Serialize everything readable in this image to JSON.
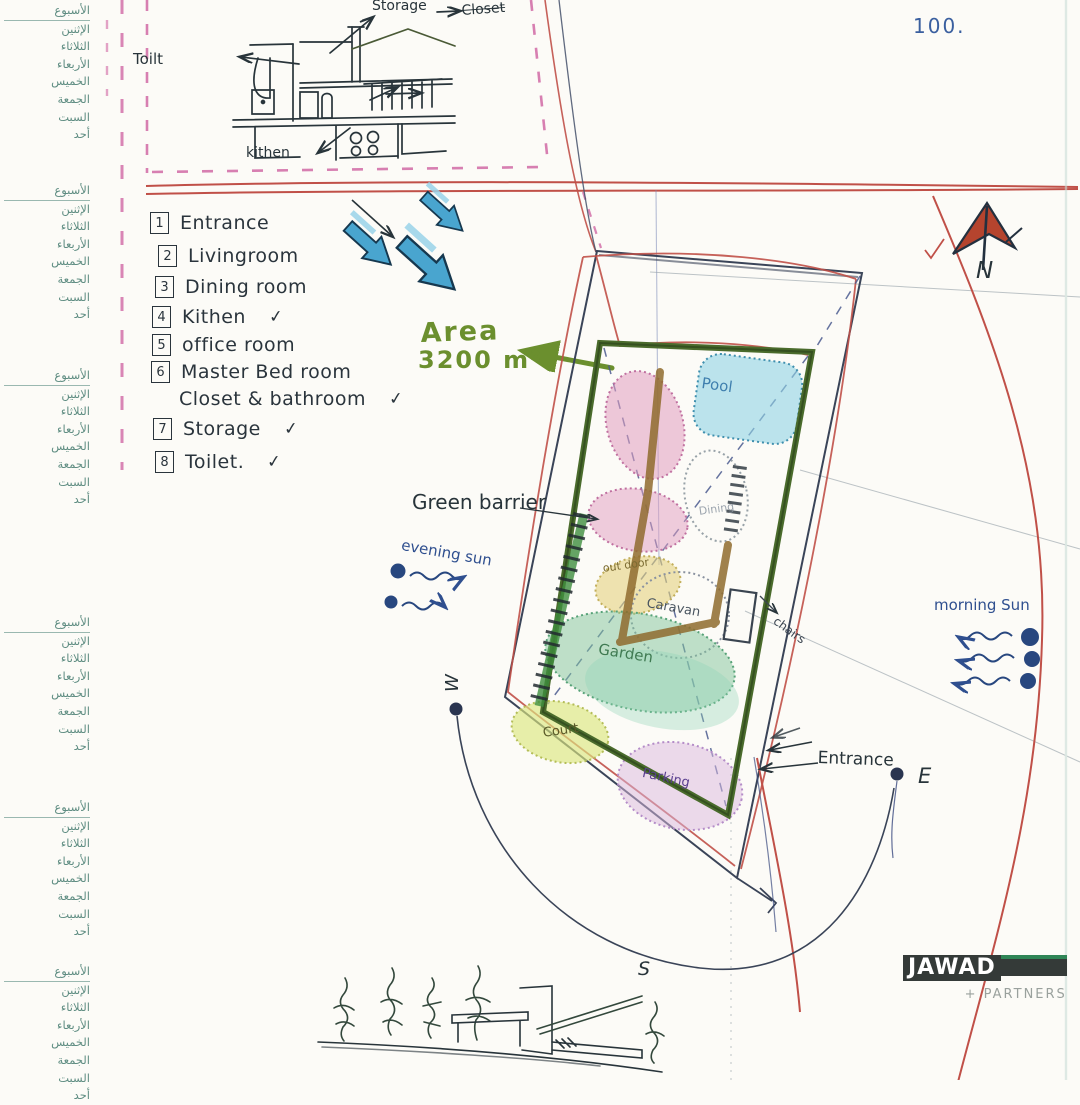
{
  "page": {
    "sheet_number": "100."
  },
  "palette": {
    "paper": "#fcfbf7",
    "ink": "#28343a",
    "red_pen": "#c05048",
    "pink_dash": "#d068a4",
    "cyan_arrow": "#49a5cf",
    "olive_marker": "#6b8f2e",
    "margin_teal": "#5f8d82",
    "blue_pen": "#2f4f8f",
    "green_wall": "#4a6b2c",
    "brown_path": "#8f6b2e",
    "logo_bar": "#343a38",
    "logo_green": "#2f8556"
  },
  "margin_calendar": {
    "week_label": "الأسبوع",
    "days": [
      "الإثنين",
      "الثلاثاء",
      "الأربعاء",
      "الخميس",
      "الجمعة",
      "السبت",
      "أحد"
    ]
  },
  "top_sketch": {
    "storage": "Storage",
    "closet": "Closet",
    "toilet": "Toilt",
    "kitchen": "kithen"
  },
  "legend": {
    "check_glyph": "✓",
    "items": [
      {
        "num": "1",
        "label": "Entrance"
      },
      {
        "num": "2",
        "label": "Livingroom"
      },
      {
        "num": "3",
        "label": "Dining room"
      },
      {
        "num": "4",
        "label": "Kithen",
        "checked": true
      },
      {
        "num": "5",
        "label": "office room"
      },
      {
        "num": "6",
        "label": "Master Bed room",
        "line2": "Closet & bathroom",
        "line2_checked": true
      },
      {
        "num": "7",
        "label": "Storage",
        "checked": true
      },
      {
        "num": "8",
        "label": "Toilet.",
        "checked": true
      }
    ]
  },
  "area_note": {
    "title": "Area",
    "value": "3200 m²"
  },
  "plan": {
    "green_barrier": "Green barrier",
    "side_note": "chairs",
    "zones": {
      "pool": "Pool",
      "dining": "Dining",
      "outdoor": "out door",
      "caravan": "Caravan",
      "garden": "Garden",
      "court": "Court",
      "parking": "Parking"
    }
  },
  "sun": {
    "evening": "evening sun",
    "morning": "morning Sun"
  },
  "compass": {
    "n": "N",
    "e": "E",
    "s": "S",
    "w": "W"
  },
  "entrance_label": "Entrance",
  "logo": {
    "brand": "JAWAD",
    "sub": "+ PARTNERS"
  }
}
